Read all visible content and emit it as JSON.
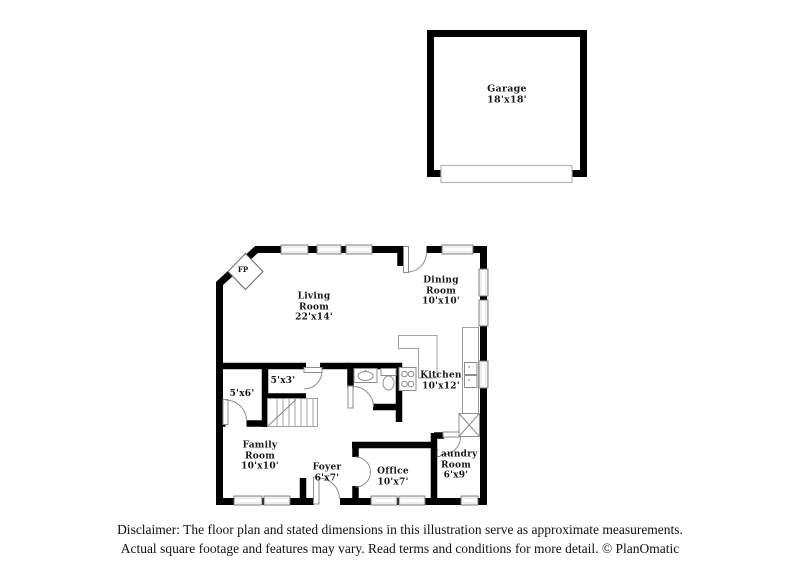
{
  "plan": {
    "rooms": {
      "garage": {
        "label": "Garage\n18'x18'"
      },
      "living": {
        "label": "Living\nRoom\n22'x14'"
      },
      "dining": {
        "label": "Dining\nRoom\n10'x10'"
      },
      "kitchen": {
        "label": "Kitchen\n10'x12'"
      },
      "family": {
        "label": "Family\nRoom\n10'x10'"
      },
      "foyer": {
        "label": "Foyer\n6'x7'"
      },
      "office": {
        "label": "Office\n10'x7'"
      },
      "laundry": {
        "label": "Laundry\nRoom\n6'x9'"
      },
      "closet_5x6": {
        "label": "5'x6'"
      },
      "closet_5x3": {
        "label": "5'x3'"
      },
      "fireplace": {
        "label": "FP"
      }
    },
    "palette": {
      "wall": "#000000",
      "background": "#ffffff",
      "window_fill": "#ededed",
      "fixture_outline": "#8d8d8d"
    }
  },
  "footer": {
    "line1": "Disclaimer: The floor plan and stated dimensions in this illustration serve as approximate measurements.",
    "line2": "Actual square footage and features may vary. Read terms and conditions for more detail. © PlanOmatic"
  }
}
